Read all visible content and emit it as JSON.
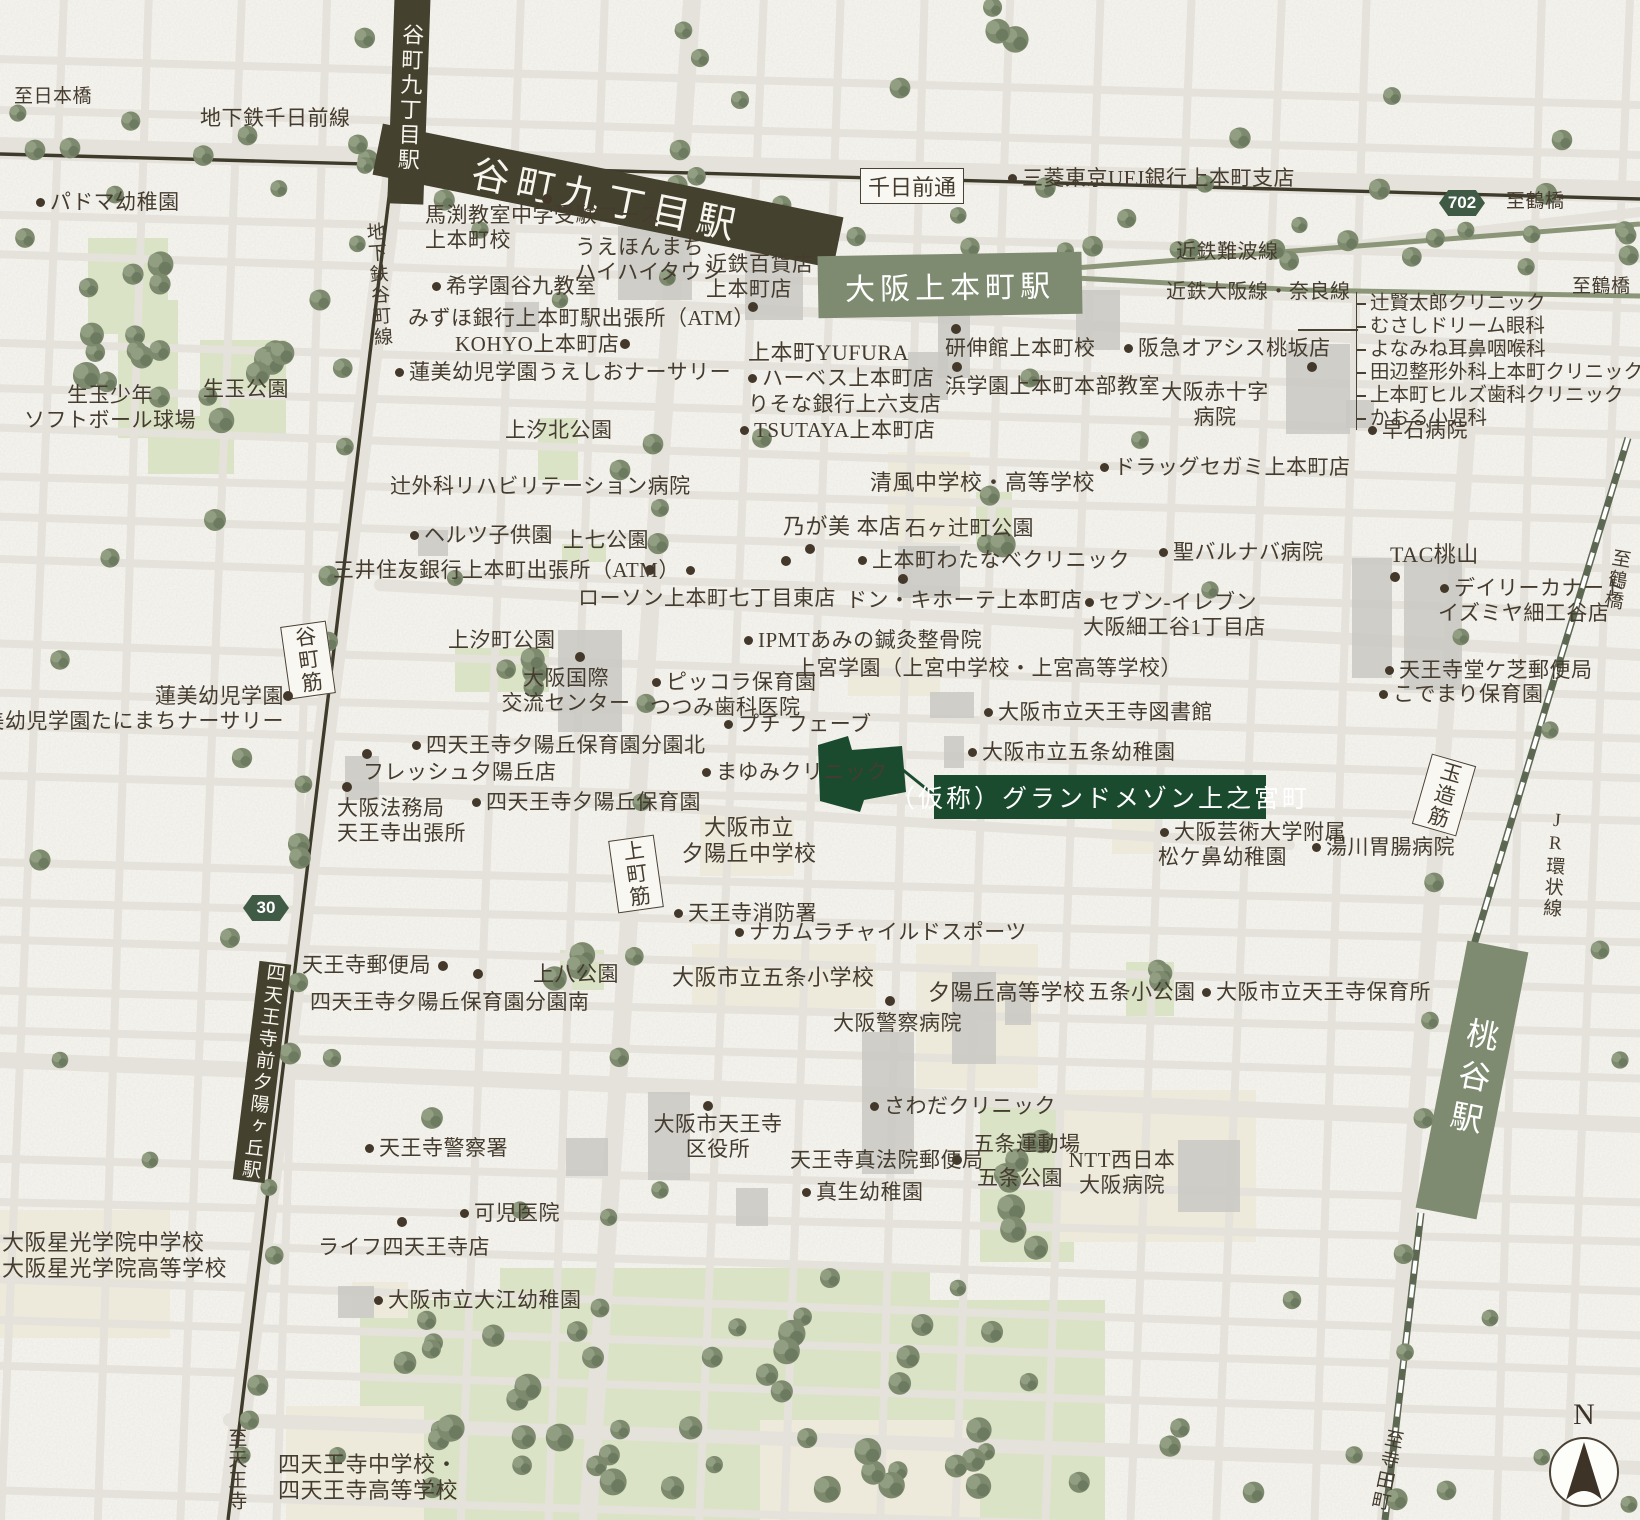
{
  "map": {
    "compass_north": "N",
    "colors": {
      "paper": "#f7f6f1",
      "road": "#e4e2da",
      "rail_dark": "#3e3b2b",
      "rail_kintetsu": "#8b9578",
      "rail_jr": "#5d6852",
      "station_dark": "#45412f",
      "station_green": "#7e8b70",
      "park": "#dbe3c6",
      "school": "#edeadb",
      "building": "#c9c8c3",
      "accent_green": "#1b4b2f",
      "text": "#453c2f",
      "tree": "#7d8a6e"
    },
    "property_site_label": "（仮称）グランドメゾン上之宮町",
    "hlines": [
      [
        1298,
        329,
        60
      ]
    ],
    "dots": [
      [
        547,
        199
      ],
      [
        753,
        307
      ],
      [
        956,
        329
      ],
      [
        957,
        367
      ],
      [
        1312,
        367
      ],
      [
        1395,
        577
      ],
      [
        903,
        579
      ],
      [
        810,
        549
      ],
      [
        786,
        561
      ],
      [
        367,
        754
      ],
      [
        347,
        787
      ],
      [
        580,
        657
      ],
      [
        478,
        974
      ],
      [
        890,
        1001
      ],
      [
        708,
        1106
      ],
      [
        402,
        1222
      ],
      [
        625,
        344
      ],
      [
        650,
        570
      ],
      [
        443,
        966
      ],
      [
        957,
        1160
      ],
      [
        288,
        696
      ]
    ],
    "labels": [
      {
        "t": "至日本橋",
        "x": 14,
        "y": 86,
        "s": 19
      },
      {
        "t": "地下鉄千日前線",
        "x": 200,
        "y": 106,
        "s": 21
      },
      {
        "t": "千日前通",
        "st": "box",
        "x": 912,
        "y": 186,
        "s": 22
      },
      {
        "t": "三菱東京UFJ銀行上本町支店",
        "x": 1006,
        "y": 166,
        "s": 21,
        "d": "l"
      },
      {
        "t": "702",
        "st": "badge",
        "x": 1462,
        "y": 203
      },
      {
        "t": "至鶴橋",
        "x": 1506,
        "y": 191,
        "s": 19
      },
      {
        "t": "近鉄難波線",
        "x": 1176,
        "y": 241,
        "s": 20
      },
      {
        "t": "近鉄大阪線・奈良線",
        "x": 1166,
        "y": 281,
        "s": 20
      },
      {
        "t": "至鶴橋",
        "x": 1572,
        "y": 276,
        "s": 19
      },
      {
        "t": "谷町九丁目駅",
        "st": "station-dark",
        "x": 608,
        "y": 196,
        "w": 470,
        "h": 52,
        "r": 11.5,
        "s": 38,
        "ls": 8
      },
      {
        "t": "谷町九丁目駅",
        "st": "station-dark",
        "x": 409,
        "y": 98,
        "w": 36,
        "h": 212,
        "r": 2,
        "v": 1,
        "s": 22
      },
      {
        "t": "大阪上本町駅",
        "st": "station-green",
        "x": 950,
        "y": 285,
        "w": 264,
        "h": 62,
        "r": -1,
        "s": 30,
        "ls": 5
      },
      {
        "t": "パドマ幼稚園",
        "x": 34,
        "y": 190,
        "s": 21,
        "d": "l"
      },
      {
        "t": "馬渕教室中学受験コース\n上本町校",
        "x": 425,
        "y": 203,
        "s": 21
      },
      {
        "t": "うえほんまち\nハイハイタウン",
        "x": 575,
        "y": 235,
        "s": 21
      },
      {
        "t": "近鉄百貨店\n上本町店",
        "x": 706,
        "y": 252,
        "s": 21
      },
      {
        "t": "希学園谷九教室",
        "x": 430,
        "y": 274,
        "s": 21,
        "d": "l"
      },
      {
        "t": "みずほ銀行上本町駅出張所（ATM）",
        "x": 408,
        "y": 306,
        "s": 21
      },
      {
        "t": "KOHYO上本町店",
        "x": 455,
        "y": 332,
        "s": 21
      },
      {
        "t": "蓮美幼児学園うえしおナーサリー",
        "x": 393,
        "y": 360,
        "s": 21,
        "d": "l"
      },
      {
        "t": "地下鉄谷町線",
        "x": 366,
        "y": 222,
        "s": 19,
        "v": 1,
        "r": -4
      },
      {
        "t": "上本町YUFURA",
        "x": 748,
        "y": 340,
        "s": 22
      },
      {
        "t": "ハーベス上本町店",
        "x": 746,
        "y": 366,
        "s": 21,
        "d": "l"
      },
      {
        "t": "りそな銀行上六支店",
        "x": 748,
        "y": 392,
        "s": 21
      },
      {
        "t": "TSUTAYA上本町店",
        "x": 738,
        "y": 418,
        "s": 21,
        "d": "l"
      },
      {
        "t": "研伸館上本町校",
        "x": 945,
        "y": 336,
        "s": 21
      },
      {
        "t": "阪急オアシス桃坂店",
        "x": 1122,
        "y": 336,
        "s": 21,
        "d": "l"
      },
      {
        "t": "浜学園上本町本部教室",
        "x": 945,
        "y": 374,
        "s": 21
      },
      {
        "t": "大阪赤十字\n病院",
        "x": 1215,
        "y": 380,
        "s": 21,
        "a": "c"
      },
      {
        "t": "早石病院",
        "x": 1366,
        "y": 418,
        "s": 21,
        "d": "l"
      },
      {
        "t": "ドラッグセガミ上本町店",
        "x": 1098,
        "y": 455,
        "s": 21,
        "d": "l"
      },
      {
        "t": "生玉少年\nソフトボール球場",
        "x": 110,
        "y": 383,
        "s": 21,
        "a": "c"
      },
      {
        "t": "生玉公園",
        "x": 203,
        "y": 377,
        "s": 21
      },
      {
        "t": "上汐北公園",
        "x": 505,
        "y": 418,
        "s": 21
      },
      {
        "t": "辻外科リハビリテーション病院",
        "x": 390,
        "y": 474,
        "s": 21
      },
      {
        "t": "ヘルツ子供園",
        "x": 408,
        "y": 523,
        "s": 21,
        "d": "l"
      },
      {
        "t": "上七公園",
        "x": 563,
        "y": 528,
        "s": 21
      },
      {
        "t": "三井住友銀行上本町出張所（ATM）",
        "x": 333,
        "y": 558,
        "s": 21,
        "d": "r"
      },
      {
        "t": "ローソン上本町七丁目東店",
        "x": 578,
        "y": 586,
        "s": 21
      },
      {
        "t": "清風中学校・高等学校",
        "x": 870,
        "y": 470,
        "s": 22
      },
      {
        "t": "乃が美 本店",
        "x": 783,
        "y": 514,
        "s": 22
      },
      {
        "t": "石ヶ辻町公園",
        "x": 905,
        "y": 516,
        "s": 21
      },
      {
        "t": "上本町わたなべクリニック",
        "x": 856,
        "y": 548,
        "s": 21,
        "d": "l"
      },
      {
        "t": "ドン・キホーテ上本町店",
        "x": 846,
        "y": 588,
        "s": 21
      },
      {
        "t": "セブン-イレブン\n大阪細工谷1丁目店",
        "x": 1083,
        "y": 590,
        "s": 21,
        "d": "l"
      },
      {
        "t": "聖バルナバ病院",
        "x": 1157,
        "y": 540,
        "s": 21,
        "d": "l"
      },
      {
        "t": "TAC桃山",
        "x": 1390,
        "y": 542,
        "s": 22
      },
      {
        "t": "デイリーカナート\nイズミヤ細工谷店",
        "x": 1438,
        "y": 576,
        "s": 21,
        "d": "l"
      },
      {
        "t": "上汐町公園",
        "x": 448,
        "y": 628,
        "s": 21
      },
      {
        "t": "大阪国際\n交流センター",
        "x": 566,
        "y": 666,
        "s": 21,
        "a": "c"
      },
      {
        "t": "ピッコラ保育園\nつつみ歯科医院",
        "x": 650,
        "y": 670,
        "s": 21,
        "d": "l"
      },
      {
        "t": "プチ フェーブ",
        "x": 722,
        "y": 712,
        "s": 21,
        "d": "l"
      },
      {
        "t": "IPMTあみの鍼灸整骨院",
        "x": 742,
        "y": 628,
        "s": 21,
        "d": "l"
      },
      {
        "t": "上宮学園（上宮中学校・上宮高等学校）",
        "x": 795,
        "y": 656,
        "s": 21
      },
      {
        "t": "大阪市立天王寺図書館",
        "x": 982,
        "y": 700,
        "s": 21,
        "d": "l"
      },
      {
        "t": "大阪市立五条幼稚園",
        "x": 966,
        "y": 740,
        "s": 21,
        "d": "l"
      },
      {
        "t": "蓮美幼児学園\n蓮美幼児学園たにまちナーサリー",
        "x": 284,
        "y": 684,
        "s": 21,
        "a": "r"
      },
      {
        "t": "四天王寺夕陽丘保育園分園北",
        "x": 410,
        "y": 733,
        "s": 21,
        "d": "l"
      },
      {
        "t": "フレッシュ夕陽丘店",
        "x": 363,
        "y": 760,
        "s": 21
      },
      {
        "t": "大阪法務局\n天王寺出張所",
        "x": 337,
        "y": 796,
        "s": 21
      },
      {
        "t": "四天王寺夕陽丘保育園",
        "x": 470,
        "y": 790,
        "s": 21,
        "d": "l"
      },
      {
        "t": "まゆみクリニック",
        "x": 700,
        "y": 760,
        "s": 21,
        "d": "l"
      },
      {
        "t": "（仮称）グランドメゾン上之宮町",
        "st": "property",
        "x": 1100,
        "y": 797,
        "w": 332,
        "h": 44,
        "s": 25
      },
      {
        "t": "大阪市立\n夕陽丘中学校",
        "x": 749,
        "y": 815,
        "s": 22,
        "a": "c"
      },
      {
        "t": "谷町筋",
        "st": "box",
        "x": 308,
        "y": 660,
        "r": -8,
        "v": 1,
        "s": 21
      },
      {
        "t": "上町筋",
        "st": "box",
        "x": 636,
        "y": 874,
        "r": -8,
        "v": 1,
        "s": 21
      },
      {
        "t": "玉造筋",
        "st": "box",
        "x": 1444,
        "y": 795,
        "r": 16,
        "v": 1,
        "s": 21
      },
      {
        "t": "大阪芸術大学附属\n松ケ鼻幼稚園",
        "x": 1158,
        "y": 820,
        "s": 21,
        "d": "l"
      },
      {
        "t": "湯川胃腸病院",
        "x": 1310,
        "y": 835,
        "s": 21,
        "d": "l"
      },
      {
        "t": "天王寺堂ケ芝郵便局",
        "x": 1383,
        "y": 658,
        "s": 21,
        "d": "l"
      },
      {
        "t": "こでまり保育園",
        "x": 1377,
        "y": 682,
        "s": 21,
        "d": "l"
      },
      {
        "t": "JR環状線",
        "x": 1542,
        "y": 810,
        "s": 19,
        "v": 1,
        "r": 4
      },
      {
        "t": "至鶴橋",
        "x": 1604,
        "y": 548,
        "s": 19,
        "v": 1,
        "r": 10
      },
      {
        "t": "30",
        "st": "badge",
        "x": 266,
        "y": 908
      },
      {
        "t": "天王寺消防署",
        "x": 672,
        "y": 901,
        "s": 21,
        "d": "l"
      },
      {
        "t": "ナカムラチャイルドスポーツ",
        "x": 733,
        "y": 920,
        "s": 21,
        "d": "l"
      },
      {
        "t": "天王寺郵便局",
        "x": 302,
        "y": 953,
        "s": 21
      },
      {
        "t": "上八公園",
        "x": 533,
        "y": 962,
        "s": 21
      },
      {
        "t": "四天王寺夕陽丘保育園分園南",
        "x": 310,
        "y": 990,
        "s": 21
      },
      {
        "t": "大阪市立五条小学校",
        "x": 672,
        "y": 965,
        "s": 22
      },
      {
        "t": "夕陽丘高等学校",
        "x": 928,
        "y": 980,
        "s": 22
      },
      {
        "t": "大阪警察病院",
        "x": 833,
        "y": 1011,
        "s": 21
      },
      {
        "t": "五条小公園",
        "x": 1088,
        "y": 980,
        "s": 21
      },
      {
        "t": "大阪市立天王寺保育所",
        "x": 1200,
        "y": 980,
        "s": 21,
        "d": "l"
      },
      {
        "t": "四天王寺前夕陽ヶ丘駅",
        "st": "station-dark",
        "x": 262,
        "y": 1072,
        "w": 32,
        "h": 220,
        "r": 7,
        "v": 1,
        "s": 19
      },
      {
        "t": "さわだクリニック",
        "x": 868,
        "y": 1094,
        "s": 21,
        "d": "l"
      },
      {
        "t": "大阪市天王寺\n区役所",
        "x": 718,
        "y": 1112,
        "s": 21,
        "a": "c"
      },
      {
        "t": "天王寺真法院郵便局",
        "x": 790,
        "y": 1148,
        "s": 21
      },
      {
        "t": "五条運動場",
        "x": 973,
        "y": 1132,
        "s": 21
      },
      {
        "t": "五条公園",
        "x": 977,
        "y": 1166,
        "s": 21
      },
      {
        "t": "NTT西日本\n大阪病院",
        "x": 1122,
        "y": 1148,
        "s": 21,
        "a": "c"
      },
      {
        "t": "真生幼稚園",
        "x": 800,
        "y": 1180,
        "s": 21,
        "d": "l"
      },
      {
        "t": "天王寺警察署",
        "x": 363,
        "y": 1136,
        "s": 21,
        "d": "l"
      },
      {
        "t": "可児医院",
        "x": 458,
        "y": 1201,
        "s": 21,
        "d": "l"
      },
      {
        "t": "ライフ四天王寺店",
        "x": 318,
        "y": 1235,
        "s": 21
      },
      {
        "t": "大阪星光学院中学校\n大阪星光学院高等学校",
        "x": 2,
        "y": 1230,
        "s": 22
      },
      {
        "t": "大阪市立大江幼稚園",
        "x": 372,
        "y": 1288,
        "s": 21,
        "d": "l"
      },
      {
        "t": "四天王寺中学校・\n四天王寺高等学校",
        "x": 278,
        "y": 1452,
        "s": 22
      },
      {
        "t": "至天王寺",
        "x": 224,
        "y": 1428,
        "s": 19,
        "v": 1
      },
      {
        "t": "至寺田町",
        "x": 1374,
        "y": 1428,
        "s": 19,
        "v": 1,
        "r": 12
      },
      {
        "t": "桃谷駅",
        "st": "station-green",
        "x": 1472,
        "y": 1080,
        "w": 62,
        "h": 272,
        "r": 11,
        "v": 1,
        "s": 32,
        "ls": 10
      }
    ],
    "clinic_group": {
      "x": 1356,
      "y": 292,
      "items": [
        "辻賢太郎クリニック",
        "むさしドリーム眼科",
        "よなみね耳鼻咽喉科",
        "田辺整形外科上本町クリニック",
        "上本町ヒルズ歯科クリニック",
        "かおる小児科"
      ]
    }
  }
}
